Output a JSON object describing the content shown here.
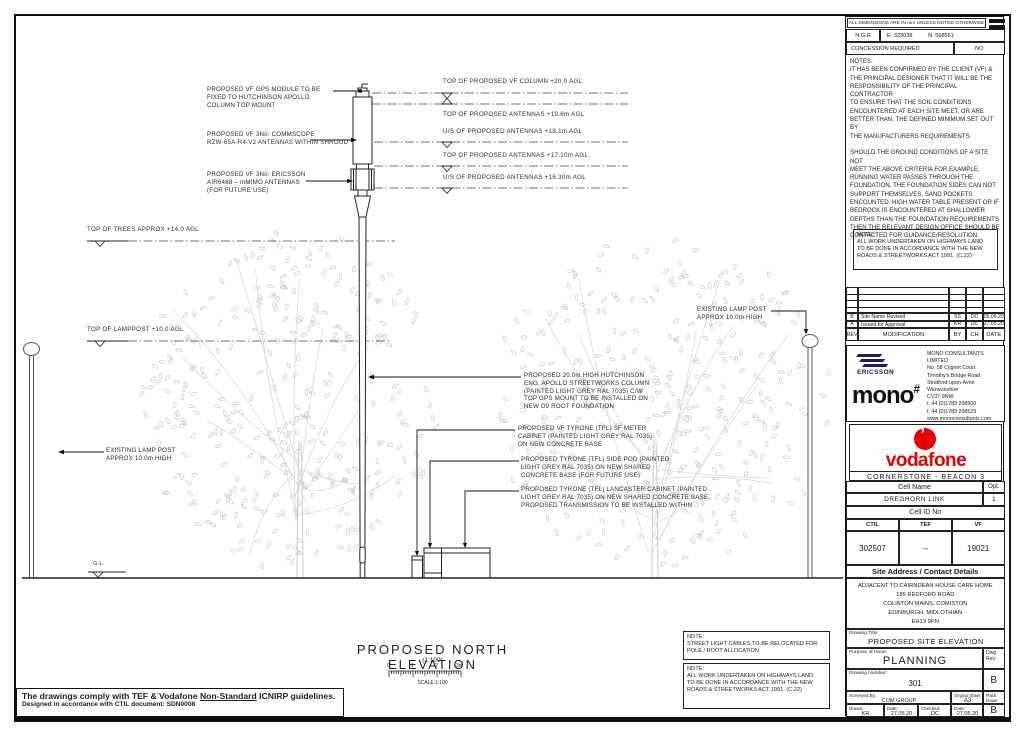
{
  "header_strip": {
    "dims_note": "ALL DIMENSIONS ARE IN mm UNLESS NOTED OTHERWISE",
    "ngr_label": "N.G.R",
    "ngr_e": "E: 323038",
    "ngr_n": "N: 668561",
    "concession_label": "CONCESSION REQUIRED",
    "concession_value": "NO"
  },
  "notes": {
    "title": "NOTES:",
    "body": "IT HAS BEEN CONFIRMED BY THE CLIENT (VF) &\nTHE PRINCIPAL DESIGNER THAT IT WILL BE THE\nRESPONSIBILITY OF THE PRINCIPAL CONTRACTOR\nTO ENSURE THAT THE SOIL CONDITIONS\nENCOUNTERED AT EACH SITE MEET, OR ARE\nBETTER THAN, THE DEFINED MINIMUM SET OUT BY\nTHE MANUFACTURERS REQUIREMENTS.\n\nSHOULD THE GROUND CONDITIONS OF A SITE NOT\nMEET THE ABOVE CRITERIA FOR EXAMPLE,\nRUNNING WATER PASSES THROUGH THE\nFOUNDATION, THE FOUNDATION SIDES CAN NOT\nSUPPORT THEMSELVES, SAND POCKETS\nENCOUNTED, HIGH WATER TABLE PRESENT OR IF\nBEDROCK IS ENCOUNTERED AT SHALLOWER\nDEPTHS THAN THE FOUNDATION REQUIREMENTS\nTHEN THE RELEVANT DESIGN OFFICE SHOULD BE\nCONTACTED FOR GUIDANCE/RESOLUTION",
    "highways_note": "NOTE:\nALL WORK UNDERTAKEN ON HIGHWAYS LAND\nTO BE DONE IN ACCORDANCE WITH THE NEW\nROADS & STREETWORKS ACT 1991. (C.22)"
  },
  "revisions": {
    "header": {
      "rev": "REV",
      "modification": "MODIFICATION",
      "by": "BY",
      "ch": "CH",
      "date": "DATE"
    },
    "rows": [
      {
        "rev": "B",
        "modification": "Site Name Revised",
        "by": "SS",
        "ch": "DC",
        "date": "05.06.20"
      },
      {
        "rev": "A",
        "modification": "Issued for Approval",
        "by": "KR",
        "ch": "DC",
        "date": "27.05.20"
      }
    ]
  },
  "company": {
    "ericsson": "ERICSSON",
    "mono": "mono",
    "mono_hash": "#",
    "address": "MONO CONSULTANTS LIMITED\nNo. 58 Cygnet Court\nTimothy's Bridge Road\nStratford-upon-Avon\nWarwickshire\nCV37 9NW\nt. 44 (0)1789 208500\nf. 44 (0)1789 208529\nwww.monoconsultants.com"
  },
  "brand": {
    "vodafone": "vodafone",
    "program": "CORNERSTONE - BEACON 3",
    "red": "#e60000"
  },
  "cell": {
    "name_label": "Cell Name",
    "opt_label": "Opt.",
    "name": "DREGHORN LINK",
    "opt": "1",
    "id_label": "Cell ID No",
    "ctil_label": "CTIL",
    "tef_label": "TEF",
    "vf_label": "VF",
    "ctil": "302507",
    "tef": "–",
    "vf": "19021"
  },
  "site": {
    "address_label": "Site Address / Contact Details",
    "address": "ADJACENT TO CAIRNDEAN HOUSE CARE HOME\n185 REDFORD ROAD\nCOLINTON MAINS, COMISTON\nEDINBURGH, MIDLOTHIAN\nEH13 9PN"
  },
  "title_block": {
    "drawing_title_label": "Drawing Title:",
    "drawing_title": "PROPOSED SITE ELEVATION",
    "purpose_label": "Purpose of Issue:",
    "purpose": "PLANNING",
    "dwg_rev_label": "Dwg\nRev:",
    "number_label": "Drawing Number:",
    "number": "301",
    "rev": "B",
    "surveyed_label": "Surveyed By:",
    "surveyed": "COM GROUP",
    "sheet_size_label": "Original Sheet Size:",
    "sheet_size": "A3",
    "pack_label": "Pack\nIssue:",
    "pack": "B",
    "drawn_label": "Drawn:",
    "drawn": "KR",
    "drawn_date_label": "Date:",
    "drawn_date": "27.05.20",
    "checked_label": "Checked:",
    "checked": "DC",
    "checked_date_label": "Date:",
    "checked_date": "27.05.20"
  },
  "drawing": {
    "title": "PROPOSED NORTH ELEVATION",
    "scale": "(1:100)",
    "scale_label": "SCALE 1:100",
    "scale_ticks": [
      "0",
      "1",
      "2",
      "3m"
    ],
    "levels": [
      "TOP OF PROPOSED VF COLUMN +20.0 AGL",
      "TOP OF PROPOSED ANTENNAS +19.6m AGL",
      "U/S OF PROPOSED ANTENNAS +18.1m AGL",
      "TOP OF PROPOSED ANTENNAS +17.10m AGL",
      "U/S OF PROPOSED ANTENNAS +16.30m AGL"
    ],
    "top_of_trees": "TOP OF TREES APPROX +14.0 AGL",
    "top_of_lamppost": "TOP OF LAMPPOST +10.0 AGL",
    "existing_lamp": "EXISTING LAMP POST\nAPPROX 10.0m HIGH",
    "gl": "G.L.",
    "callout_gps": "PROPOSED VF GPS MODULE TO BE\nFIXED TO HUTCHINSON APOLLO\nCOLUMN TOP MOUNT",
    "callout_commscope": "PROPOSED VF 3No. COMMSCOPE\nRZW-65A-R4-V2 ANTENNAS WITHIN SHROUD",
    "callout_mmimo": "PROPOSED VF 3No. ERICSSON\nAIR6488 – mMIMO ANTENNAS\n(FOR FUTURE USE)",
    "callout_column": "PROPOSED 20.0m HIGH HUTCHINSON\nENG. APOLLO STREETWORKS COLUMN\n(PAINTED LIGHT GREY RAL 7035) C/W\nTOP GPS MOUNT TO BE INSTALLED ON\nNEW D9 ROOT FOUNDATION",
    "callout_meter": "PROPOSED VF TYRONE (TFL) SF METER\nCABINET (PAINTED LIGHT GREY RAL 7035)\nON NEW CONCRETE BASE",
    "callout_sidepod": "PROPOSED TYRONE (TFL) SIDE POD (PAINTED\nLIGHT GREY RAL 7035) ON NEW SHARED\nCONCRETE BASE (FOR FUTURE USE)",
    "callout_lancaster": "PROPOSED TYRONE (TFL) LANCASTER CABINET (PAINTED\nLIGHT GREY RAL 7035) ON NEW SHARED CONCRETE BASE.\nPROPOSED TRANSMISSION TO BE INSTALLED WITHIN"
  },
  "bottom_notes": {
    "note1": "NOTE:\nSTREET LIGHT CABLES TO BE RELOCATED FOR\nPOLE / ROOT ALLOCATION",
    "note2": "NOTE:\nALL WORK UNDERTAKEN ON HIGHWAYS LAND\nTO BE DONE IN ACCORDANCE WITH THE NEW\nROADS & STREETWORKS ACT 1991. (C.22)"
  },
  "footer": {
    "icnirp_a": "The drawings comply with TEF & Vodafone ",
    "icnirp_u": "Non-Standard",
    "icnirp_b": " ICNIRP guidelines.",
    "ctil_doc": "Designed in accordance with CTIL document: SDN0008"
  }
}
